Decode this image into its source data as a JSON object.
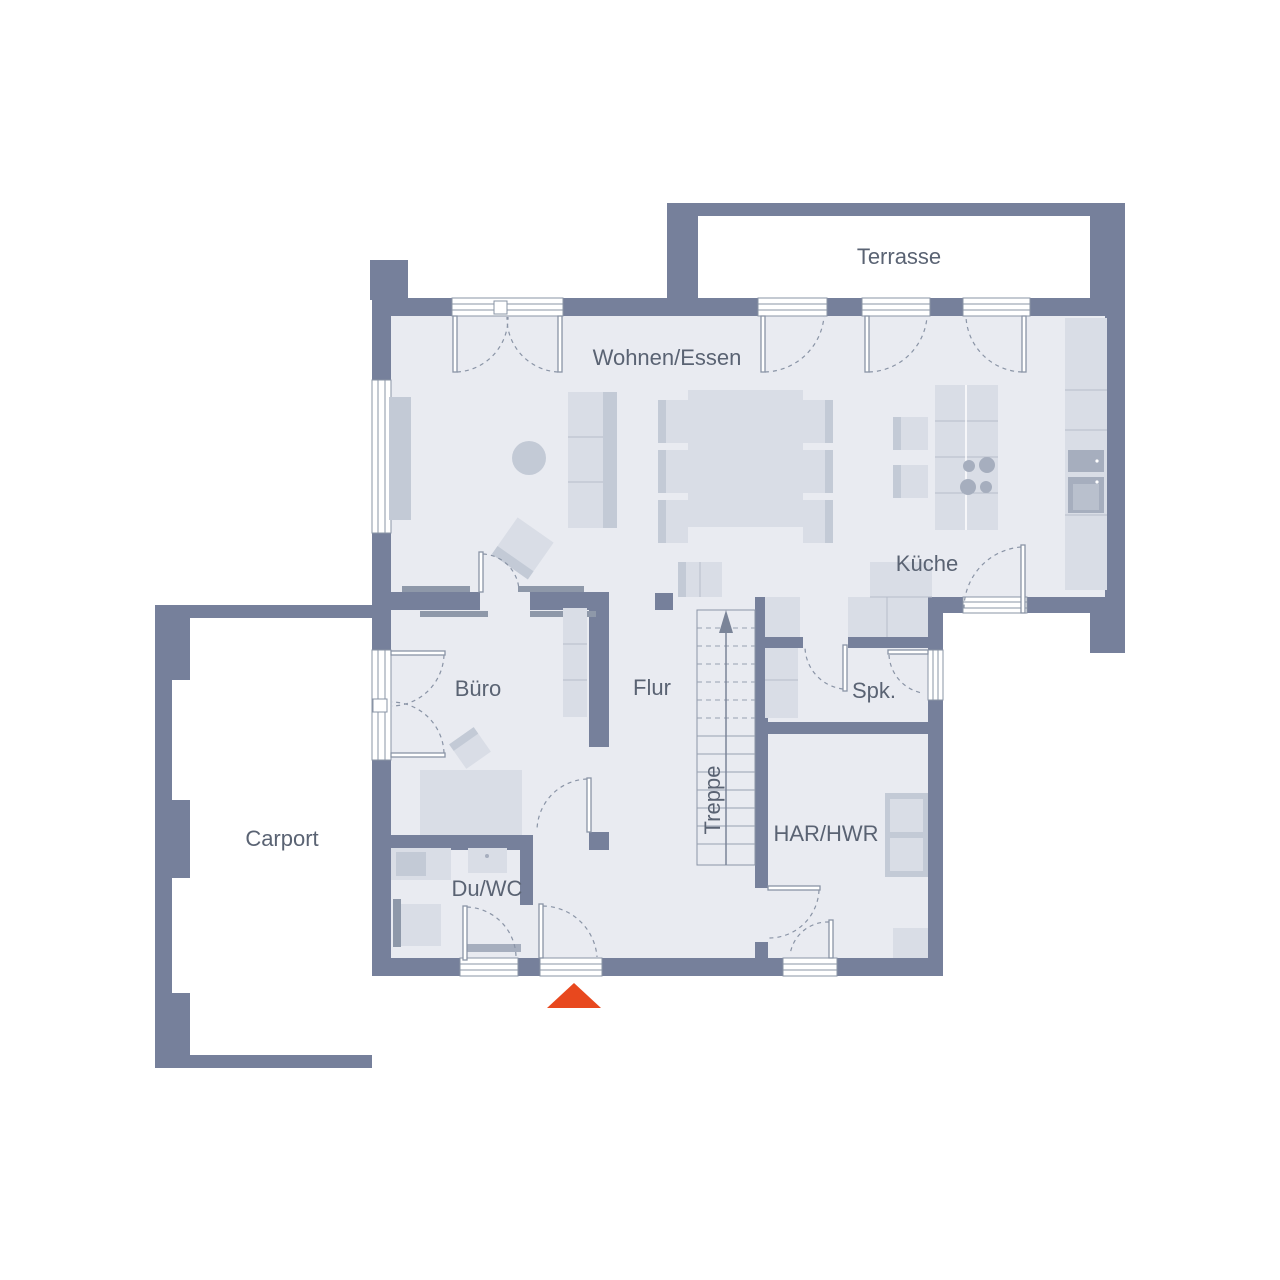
{
  "rooms": {
    "terrasse": {
      "label": "Terrasse"
    },
    "wohnen_essen": {
      "label": "Wohnen/Essen"
    },
    "kueche": {
      "label": "Küche"
    },
    "buero": {
      "label": "Büro"
    },
    "flur": {
      "label": "Flur"
    },
    "spk": {
      "label": "Spk."
    },
    "treppe": {
      "label": "Treppe"
    },
    "har_hwr": {
      "label": "HAR/HWR"
    },
    "du_wc": {
      "label": "Du/WC"
    },
    "carport": {
      "label": "Carport"
    }
  },
  "entrance_marker": {
    "shape": "triangle-up",
    "color": "#E8481E"
  },
  "colors": {
    "wall": "#76809B",
    "floor": "#E9EBF1",
    "furniture_light": "#D9DDE6",
    "furniture_medium": "#C3CAD6",
    "appliance": "#A6AEBE",
    "line": "#8A94A6",
    "bar": "#8E98A9",
    "text": "#5A6373",
    "accent": "#E8481E",
    "background": "#FFFFFF"
  }
}
